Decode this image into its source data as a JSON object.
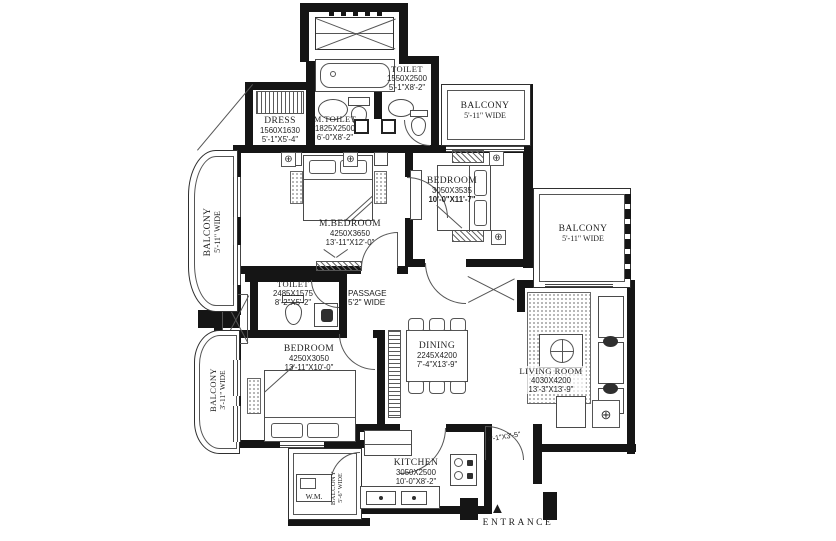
{
  "colors": {
    "wall": "#151515",
    "line": "#4a4a4a",
    "bg": "#ffffff"
  },
  "icons": {
    "fan": "⊕",
    "entrance_arrow": "▲",
    "table_symbol": "⊕"
  },
  "labels": {
    "dress": {
      "name": "DRESS",
      "mm": "1560X1630",
      "ft": "5'-1\"X5'-4\""
    },
    "m_toilet": {
      "name": "M.TOILET",
      "mm": "1825X2500",
      "ft": "6'-0\"X8'-2\""
    },
    "toilet_top": {
      "name": "TOILET",
      "mm": "1550X2500",
      "ft": "5'-1\"X8'-2\""
    },
    "balcony_tr": {
      "name": "BALCONY",
      "w": "5'-11\" WIDE"
    },
    "balcony_l": {
      "name": "BALCONY",
      "w": "5'-11\" WIDE"
    },
    "balcony_r": {
      "name": "BALCONY",
      "w": "5'-11\" WIDE"
    },
    "balcony_bl": {
      "name": "BALCONY",
      "w": "3'-11\" WIDE"
    },
    "balcony_u": {
      "name": "BALCONY",
      "w": "5'-6\" WIDE"
    },
    "m_bedroom": {
      "name": "M.BEDROOM",
      "mm": "4250X3650",
      "ft": "13'-11\"X12'-0\""
    },
    "bedroom_tr": {
      "name": "BEDROOM",
      "mm": "3050X3535",
      "ft": "10'-0\"X11'-7\""
    },
    "bedroom_b": {
      "name": "BEDROOM",
      "mm": "4250X3050",
      "ft": "13'-11\"X10'-0\""
    },
    "toilet_m": {
      "name": "TOILET",
      "mm": "2485X1575",
      "ft": "8'-2\"X5'-2\""
    },
    "passage": {
      "name": "PASSAGE",
      "w": "5'2\" WIDE"
    },
    "dining": {
      "name": "DINING",
      "mm": "2245X4200",
      "ft": "7'-4\"X13'-9\""
    },
    "living": {
      "name": "LIVING ROOM",
      "mm": "4030X4200",
      "ft": "13'-3\"X13'-9\""
    },
    "kitchen": {
      "name": "KITCHEN",
      "mm": "3050X2500",
      "ft": "10'-0\"X8'-2\""
    },
    "wm": {
      "name": "W.M."
    },
    "foyer": {
      "ft": "4'-1\"X3'-5\""
    },
    "entrance": {
      "name": "ENTRANCE"
    }
  }
}
